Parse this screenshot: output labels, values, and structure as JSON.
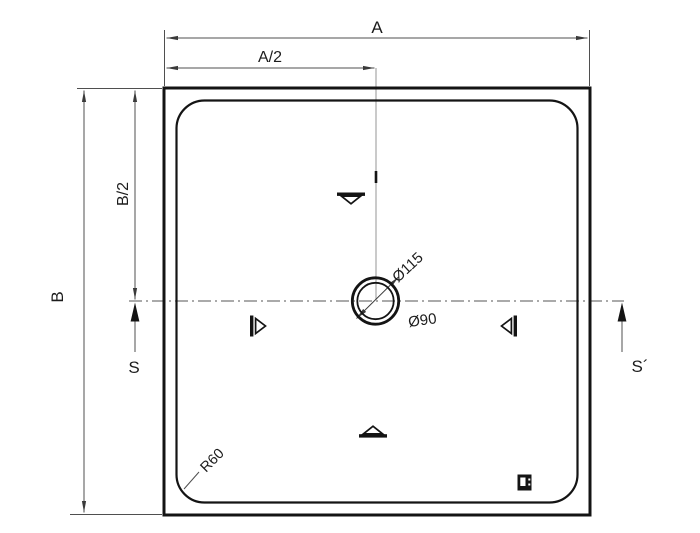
{
  "drawing": {
    "background": "#ffffff",
    "outline_color": "#141414",
    "dimension_color": "#4f4f4f",
    "labels": {
      "dim_a": "A",
      "dim_a_half": "A/2",
      "dim_b": "B",
      "dim_b_half": "B/2",
      "drain_outer_dia": "Ø115",
      "drain_inner_dia": "Ø90",
      "corner_radius": "R60",
      "section_left": "S",
      "section_right": "S´"
    }
  }
}
